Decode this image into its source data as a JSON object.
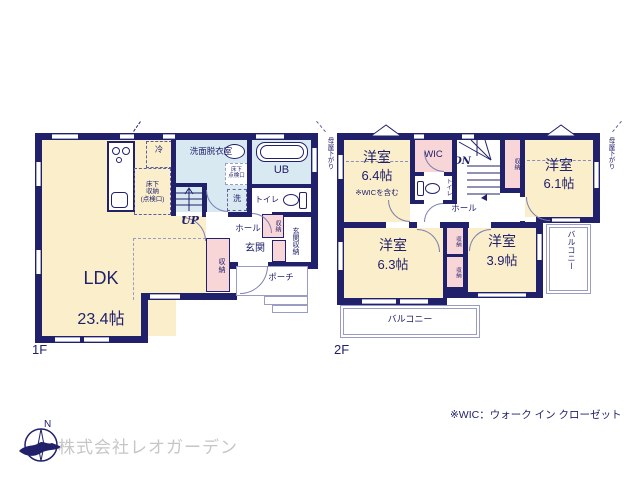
{
  "palette": {
    "wall_navy": "#21216b",
    "room_cream": "#faeecb",
    "wet_blue": "#d9e9f2",
    "storage_pink": "#f8d6d8",
    "text_navy": "#21216b",
    "company_gray": "#c6c6c8"
  },
  "f1": {
    "label": "1F",
    "ldk": "LDK",
    "ldk_size": "23.4帖",
    "fridge": "冷",
    "floor_storage": "床下\n収納\n(点検口)",
    "washroom": "洗面脱衣室",
    "floor_hatch": "床下\n点検口",
    "bath": "UB",
    "washer": "洗",
    "toilet": "トイレ",
    "up": "UP",
    "hall": "ホール",
    "storage_hall": "収納",
    "entrance": "玄関",
    "entrance_storage": "玄関収納",
    "storage_ldk": "収納",
    "porch": "ポーチ"
  },
  "f2": {
    "label": "2F",
    "room1": "洋室",
    "room1_size": "6.4帖",
    "room1_note": "※WICを含む",
    "wic": "WIC",
    "dn": "DN",
    "storage_stairs": "収納",
    "room2": "洋室",
    "room2_size": "6.1帖",
    "toilet": "トイレ",
    "hall": "ホール",
    "room3": "洋室",
    "room3_size": "6.3帖",
    "storage_a": "収納",
    "storage_b": "収納",
    "room4": "洋室",
    "room4_size": "3.9帖",
    "balcony_right": "バルコニー",
    "balcony_bottom": "バルコニー",
    "moya_left": "母屋下がり",
    "moya_right": "母屋下がり"
  },
  "footer": {
    "compass_n": "N",
    "company": "株式会社レオガーデン",
    "wic_note": "※WIC：ウォーク イン クローゼット"
  }
}
